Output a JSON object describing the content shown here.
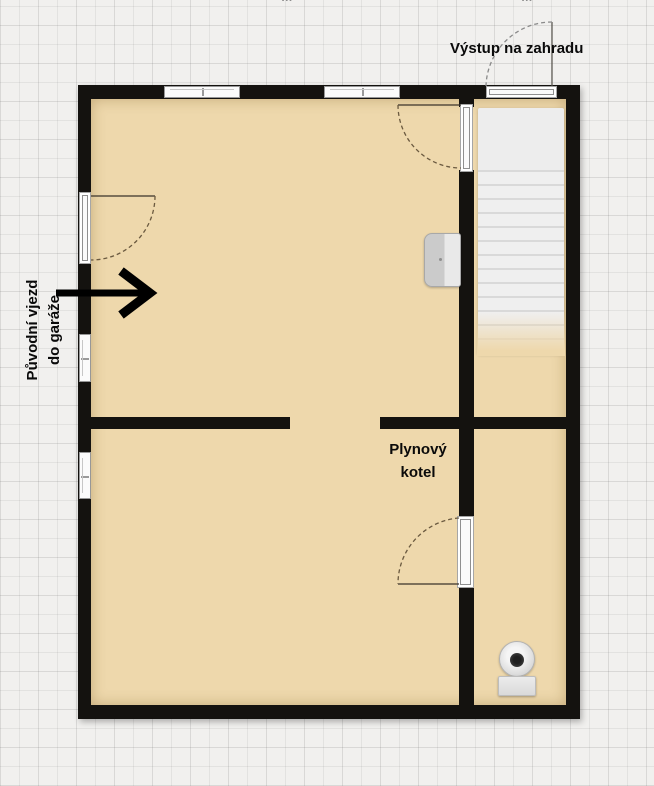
{
  "plan": {
    "type": "floor-plan",
    "labels": {
      "garden_exit": "Výstup na zahradu",
      "boiler": {
        "line1": "Plynový",
        "line2": "kotel"
      },
      "original_garage_entrance": {
        "line1": "Původní vjezd",
        "line2": "do garáže"
      },
      "dim_top_left": "····· m",
      "dim_top_right": "····· m"
    },
    "colors": {
      "floor": "#eed8ac",
      "wall": "#14120f",
      "grid_background": "#f1f0ee",
      "stairs": "#ededed",
      "door_arc": "#6b5a40",
      "label_text": "#0a0a0a"
    },
    "fixtures": {
      "stairs": "staircase-to-garden",
      "toilet": "toilet",
      "boiler_unit": "wall-mounted-gas-boiler",
      "doors": [
        "exterior-left-door",
        "garden-exit-door",
        "interior-upper-door",
        "interior-lower-door"
      ],
      "windows": [
        "top-window-left",
        "top-window-right",
        "left-window-upper",
        "left-window-lower"
      ]
    }
  }
}
